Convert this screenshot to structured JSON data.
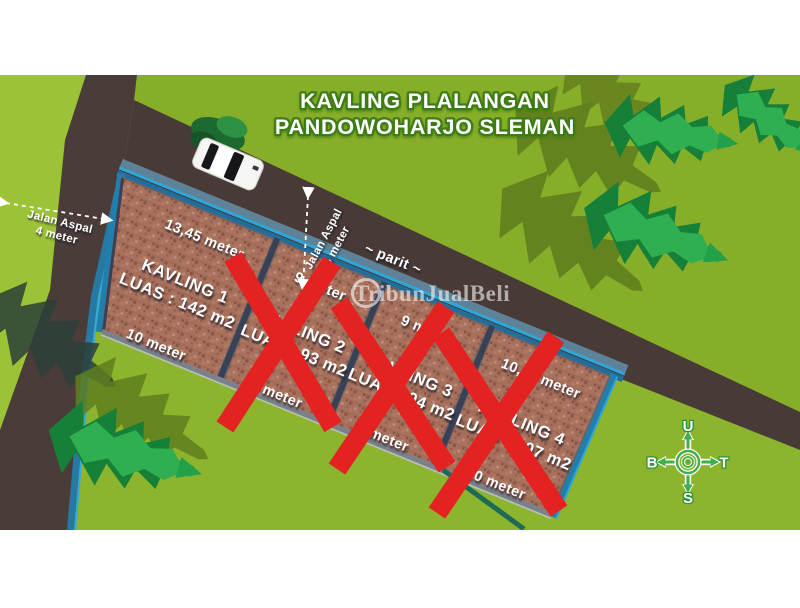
{
  "title": {
    "line1": "KAVLING PLALANGAN",
    "line2": "PANDOWOHARJO SLEMAN"
  },
  "watermark": {
    "text": "TribunJualBeli"
  },
  "roads": {
    "west_road": {
      "label_line1": "Jalan Aspal",
      "label_line2": "4 meter"
    },
    "north_road": {
      "label_line1": "Jalan Aspal",
      "label_line2": "5 meter"
    },
    "ditch_label": "~ parit ~"
  },
  "plots": [
    {
      "name": "KAVLING 1",
      "area": "LUAS : 142 m2",
      "top_edge": "13,45 meter",
      "bottom_edge": "10 meter",
      "sold": false
    },
    {
      "name": "KAVLING 2",
      "area": "LUAS : 93 m2",
      "top_edge": "9 meter",
      "bottom_edge": "9 meter",
      "sold": true
    },
    {
      "name": "KAVLING 3",
      "area": "LUAS : 94 m2",
      "top_edge": "9 meter",
      "bottom_edge": "9 meter",
      "sold": true
    },
    {
      "name": "KAVLING 4",
      "area": "LUAS : 107 m2",
      "top_edge": "10,25 meter",
      "bottom_edge": "10 meter",
      "sold": true
    }
  ],
  "compass": {
    "north": "U",
    "east": "T",
    "south": "S",
    "west": "B"
  },
  "colors": {
    "grass": "#8CB42C",
    "grass_light": "#9CC337",
    "road": "#483B37",
    "plot_brown": "#A8715E",
    "border_blue": "#1F7FAE",
    "ditch_blue": "#2FA6D8",
    "sold_x_red": "#E32221",
    "title_outline_green": "#3E7C15",
    "tree_green": "#2FAF51"
  }
}
